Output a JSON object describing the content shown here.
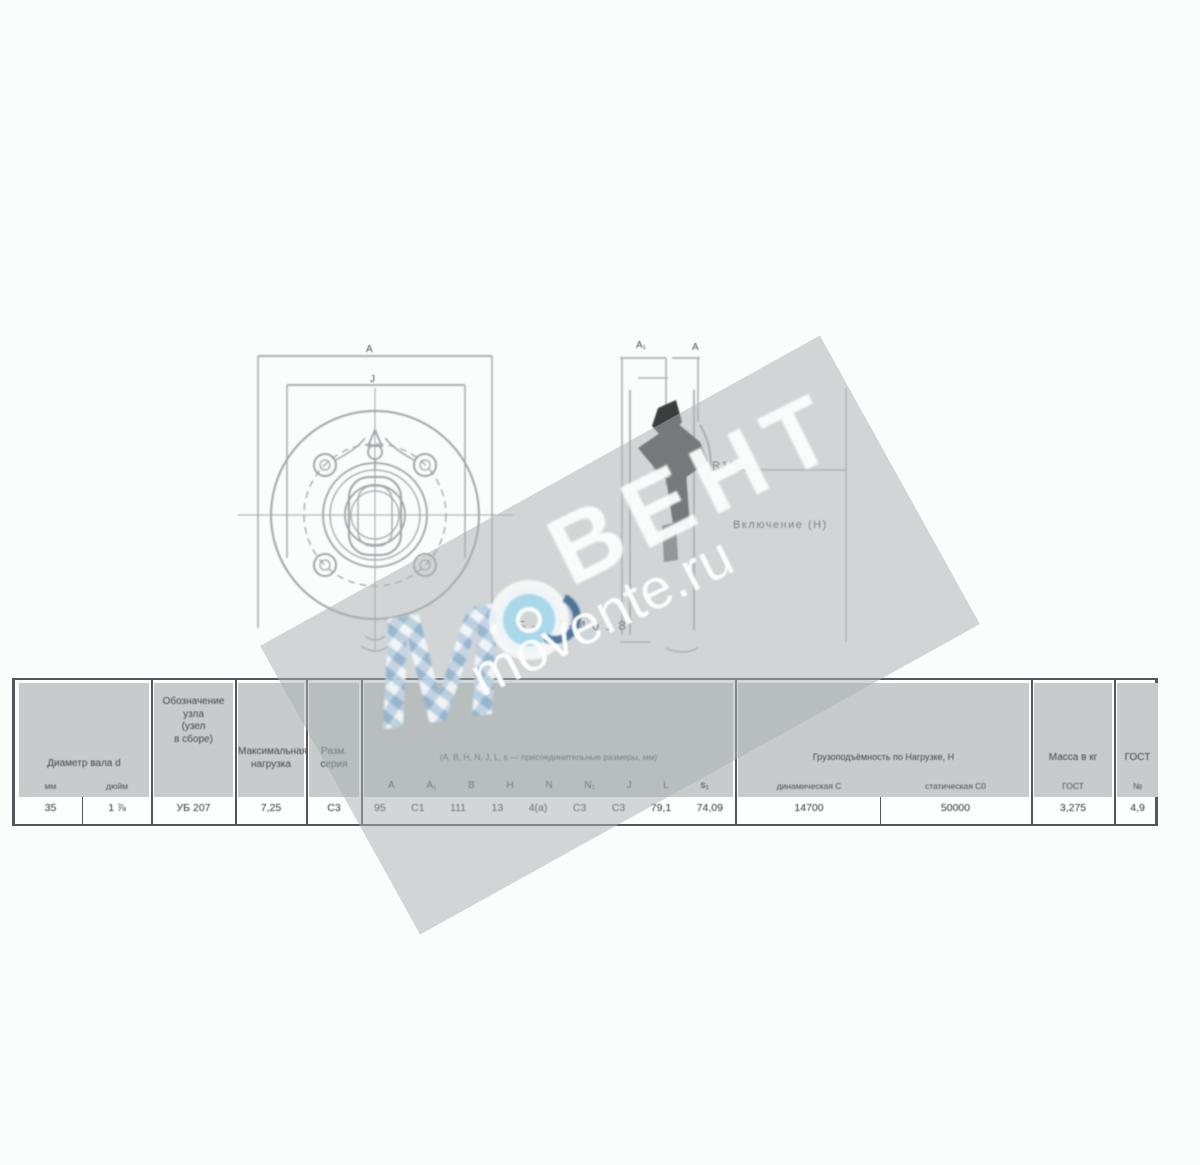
{
  "watermark": {
    "letter_m": "М",
    "brand": "ВЕНТ",
    "site": "movente.ru",
    "band_color": "#aab0b0",
    "logo_ring_blue": "#a9d8ea",
    "logo_dark_blue": "#35648f"
  },
  "drawing": {
    "designation": "УВБ-07-4018",
    "front_dim_outer": "А",
    "front_dim_inner": "J",
    "side_dim_a1": "А₁",
    "side_dim_a": "А",
    "callout_thread": "≈ R1/8",
    "callout_note": "Включение (Н)",
    "line_color": "#8f9698",
    "section_color": "#1b1d1e"
  },
  "table": {
    "border_color": "#53585a",
    "cell_fill": "#c7cbcb",
    "shaft": {
      "header": "Диаметр вала d",
      "mm_label": "мм",
      "mm_value": "35",
      "inch_label": "дюйм",
      "inch_value": "1 ⅞"
    },
    "unit": {
      "l1": "Обозначение",
      "l2": "узла",
      "l3": "(узел",
      "l4": "в сборе)",
      "value": "УБ 207"
    },
    "max_load": {
      "l1": "Максимальная",
      "l2": "нагрузка",
      "value": "7,25"
    },
    "series": {
      "l1": "Разм.",
      "l2": "серия",
      "value": "С3"
    },
    "dims": {
      "header": "(А, В, Н, N, J, L, s — присоединительные размеры, мм)",
      "letters": [
        "А",
        "А₁",
        "В",
        "Н",
        "N",
        "N₁",
        "J",
        "L",
        "s₁"
      ],
      "values": [
        "95",
        "С1",
        "111",
        "13",
        "4(а)",
        "С3",
        "С3",
        "79,1",
        "74,09"
      ]
    },
    "capacity": {
      "header": "Грузоподъёмность по Нагрузке, Н",
      "dyn_label": "динамическая С",
      "dyn_value": "14700",
      "stat_label": "статическая С0",
      "stat_value": "50000"
    },
    "mass": {
      "header": "Масса в кг",
      "sub": "ГОСТ",
      "value": "3,275"
    },
    "gost": {
      "header": "ГОСТ",
      "sub": "№",
      "value": "4,9"
    }
  }
}
